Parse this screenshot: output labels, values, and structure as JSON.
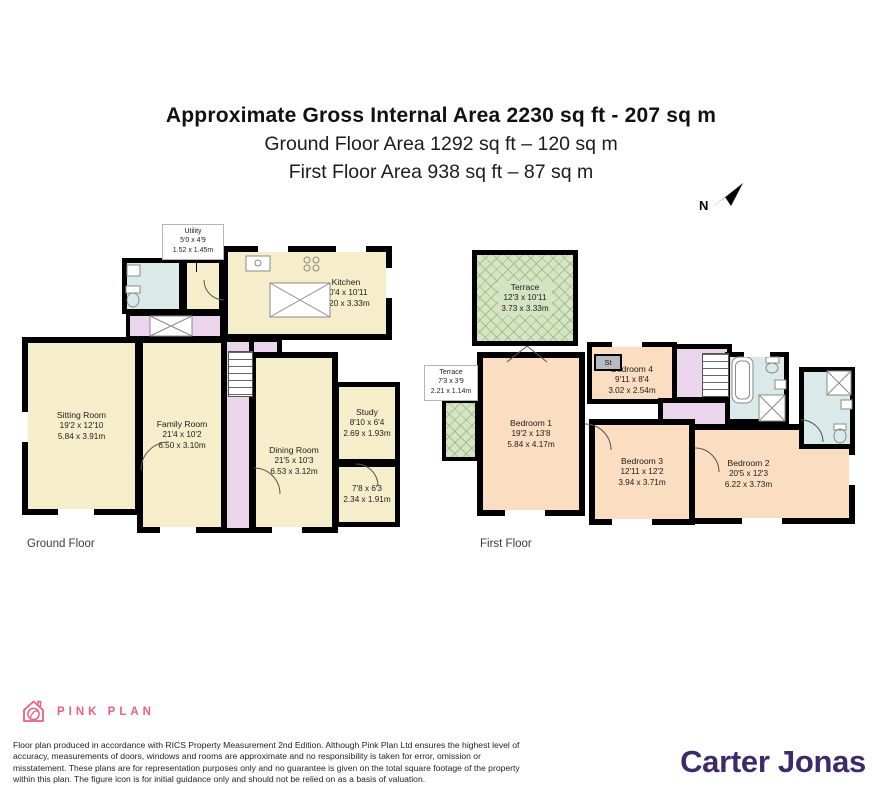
{
  "header": {
    "line1": "Approximate Gross Internal Area 2230 sq ft - 207 sq m",
    "line2": "Ground Floor Area 1292 sq ft – 120 sq m",
    "line3": "First Floor Area 938 sq ft – 87 sq m"
  },
  "compass": {
    "label": "N"
  },
  "ground_floor": {
    "caption": "Ground Floor",
    "rooms": {
      "utility": {
        "name": "Utility",
        "ft": "5'0 x 4'9",
        "m": "1.52 x 1.45m"
      },
      "kitchen": {
        "name": "Kitchen",
        "ft": "20'4 x 10'11",
        "m": "6.20 x 3.33m"
      },
      "sitting": {
        "name": "Sitting Room",
        "ft": "19'2 x 12'10",
        "m": "5.84 x 3.91m"
      },
      "family": {
        "name": "Family Room",
        "ft": "21'4 x 10'2",
        "m": "6.50 x 3.10m"
      },
      "dining": {
        "name": "Dining Room",
        "ft": "21'5 x 10'3",
        "m": "6.53 x 3.12m"
      },
      "study": {
        "name": "Study",
        "ft": "8'10 x 6'4",
        "m": "2.69 x 1.93m"
      },
      "store": {
        "ft": "7'8 x 6'3",
        "m": "2.34 x 1.91m"
      }
    }
  },
  "first_floor": {
    "caption": "First Floor",
    "rooms": {
      "terrace_top": {
        "name": "Terrace",
        "ft": "12'3 x 10'11",
        "m": "3.73 x 3.33m"
      },
      "terrace_left": {
        "name": "Terrace",
        "ft": "7'3 x 3'9",
        "m": "2.21 x 1.14m"
      },
      "bed1": {
        "name": "Bedroom 1",
        "ft": "19'2 x 13'8",
        "m": "5.84 x 4.17m"
      },
      "bed4": {
        "name": "Bedroom 4",
        "ft": "9'11 x 8'4",
        "m": "3.02 x 2.54m"
      },
      "bed3": {
        "name": "Bedroom 3",
        "ft": "12'11 x 12'2",
        "m": "3.94 x 3.71m"
      },
      "bed2": {
        "name": "Bedroom 2",
        "ft": "20'5 x 12'3",
        "m": "6.22 x 3.73m"
      },
      "st": {
        "name": "St"
      }
    }
  },
  "footer": {
    "logo_text": "PINK PLAN",
    "disclaimer": "Floor plan produced in accordance with RICS Property Measurement 2nd Edition. Although Pink Plan Ltd ensures the highest level of accuracy, measurements of doors, windows and rooms are approximate and no responsibility is taken for error, omission or misstatement. These plans are for representation purposes only and no guarantee is given on the total square footage of the property within this plan. The figure icon is for initial guidance only and should not be relied on as a basis of valuation.",
    "brand": "Carter Jonas"
  },
  "colors": {
    "wall": "#000000",
    "ground_room": "#f6eecb",
    "first_room": "#fbddc1",
    "hall": "#ead5ec",
    "bathroom": "#daeae8",
    "terrace": "#d5e5c4",
    "pink": "#ed5f80",
    "brand_purple": "#3d2a6b"
  }
}
